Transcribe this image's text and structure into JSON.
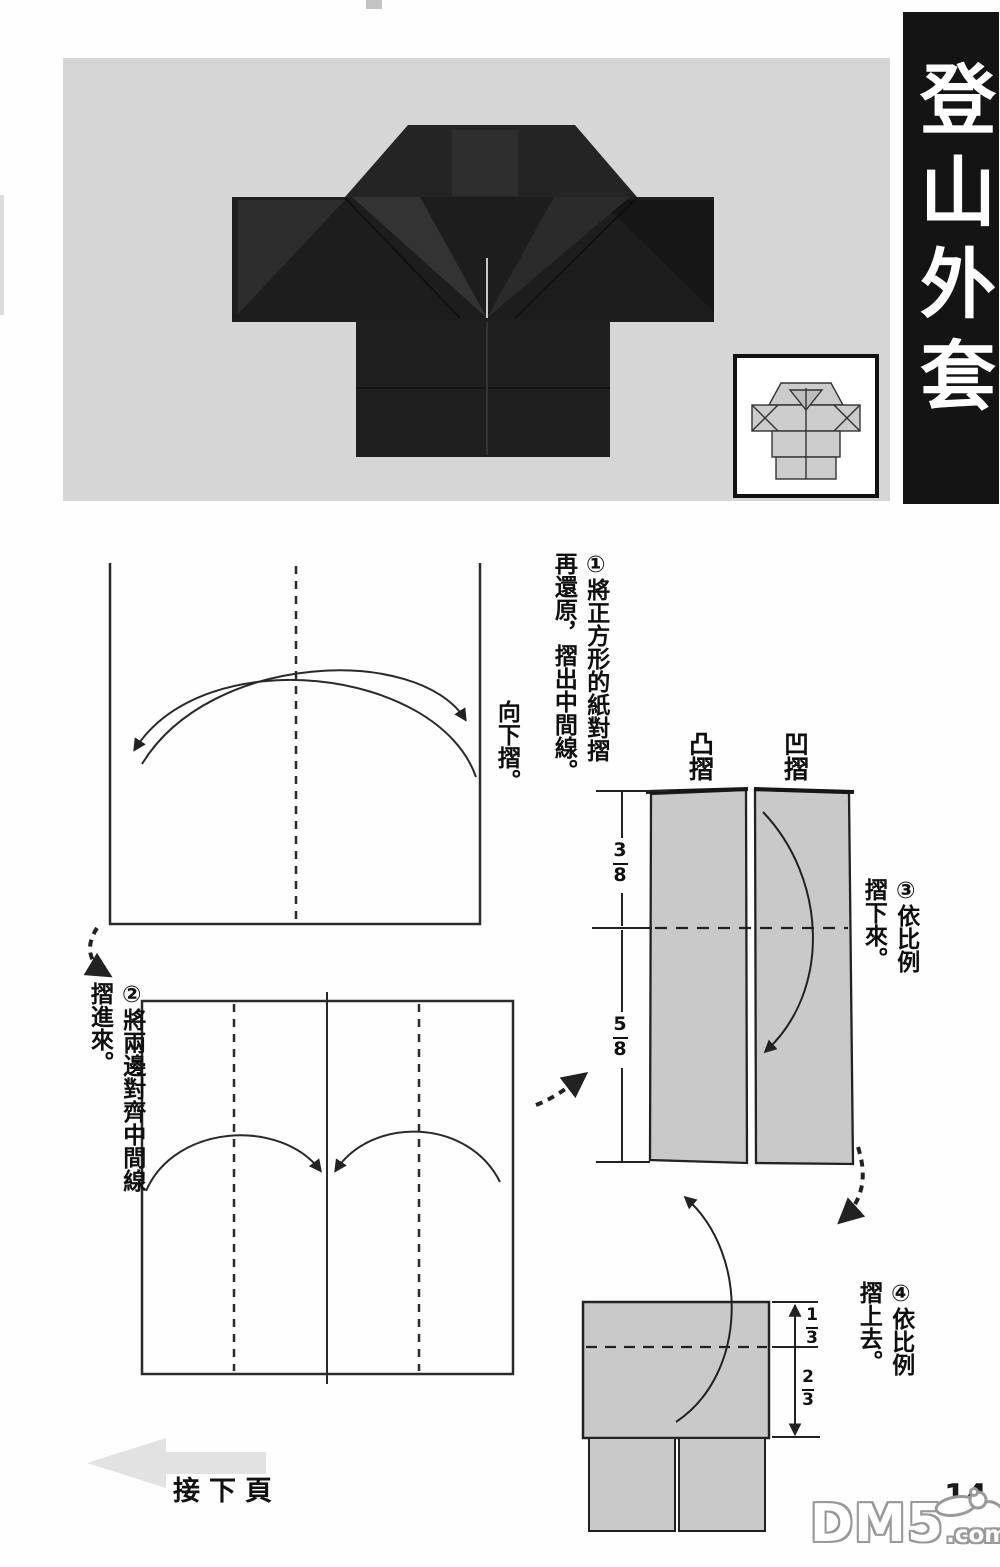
{
  "banner": {
    "title": "登山外套"
  },
  "steps": {
    "s1": {
      "text_main": "①將正方形的紙對摺",
      "text_cont": "再還原，摺出中間線。",
      "side_note": "向下摺。"
    },
    "s2": {
      "text_main": "②將兩邊對齊中間線",
      "text_cont": "摺進來。"
    },
    "s3": {
      "text_main": "③依比例",
      "text_cont": "摺下來。",
      "fold_label_mountain": "凸摺",
      "fold_label_valley": "凹摺",
      "fraction_upper": {
        "num": "3",
        "den": "8"
      },
      "fraction_lower": {
        "num": "5",
        "den": "8"
      }
    },
    "s4": {
      "text_main": "④依比例",
      "text_cont": "摺上去。",
      "fraction_upper": {
        "num": "1",
        "den": "3"
      },
      "fraction_lower": {
        "num": "2",
        "den": "3"
      }
    }
  },
  "footer": {
    "next_page_label": "接下頁",
    "page_number": "14"
  },
  "watermark": {
    "brand": "DM5",
    "suffix": ".com"
  },
  "colors": {
    "photo_background": "#d6d6d6",
    "jacket_dark": "#1d1d1d",
    "diagram_paper_gray": "#c9c9c9",
    "banner_background": "#141414",
    "line_ink": "#232323",
    "next_arrow_gray": "#e2e2e2",
    "watermark_gray": "#999999"
  }
}
